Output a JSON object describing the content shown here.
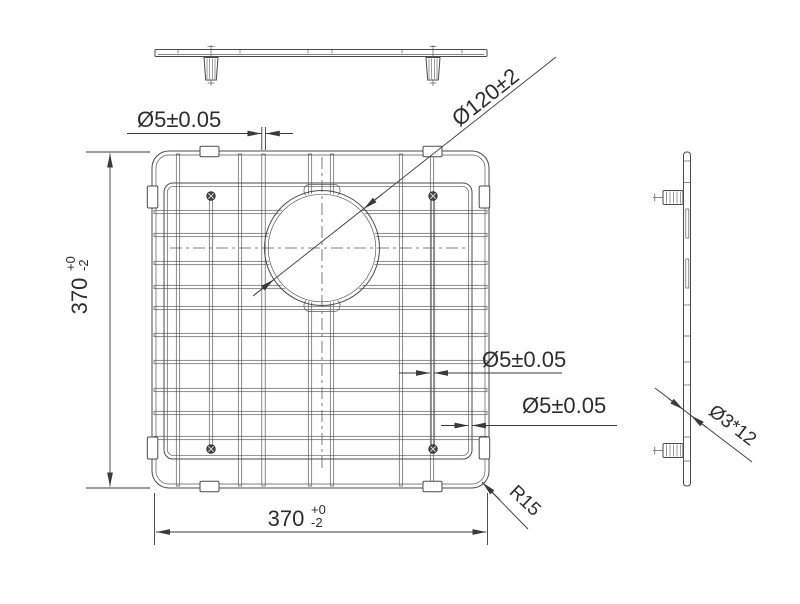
{
  "colors": {
    "background": "#ffffff",
    "geometry_line": "#4a4a4a",
    "dimension_line": "#3a3a3a",
    "text": "#2d2d2d"
  },
  "dimensions": {
    "wire_diameter_top": "Ø5±0.05",
    "hole_diameter": "Ø120±2",
    "height": {
      "value": "370",
      "tol_upper": "+0",
      "tol_lower": "-2"
    },
    "width": {
      "value": "370",
      "tol_upper": "+0",
      "tol_lower": "-2"
    },
    "wire_diameter_right_1": "Ø5±0.05",
    "wire_diameter_right_2": "Ø5±0.05",
    "corner_radius": "R15",
    "foot_size": "Ø3*12"
  }
}
